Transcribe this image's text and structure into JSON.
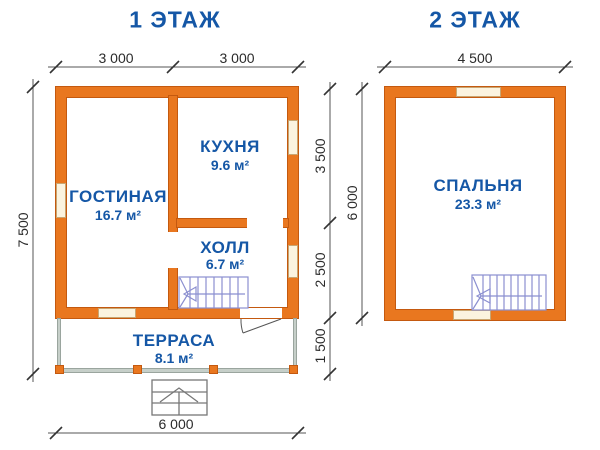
{
  "colors": {
    "wall_orange": "#E9771F",
    "wall_outline": "#C4590F",
    "window_fill": "#FBF3DF",
    "window_outline": "#C9A671",
    "label_blue": "#1557A6",
    "terrace_wall": "#C6CFC9",
    "stair_line": "#8B8FD0",
    "dimension_line": "#555555",
    "background": "#FFFFFF"
  },
  "floor1": {
    "title": "1 ЭТАЖ",
    "rooms": [
      {
        "name": "ГОСТИНАЯ",
        "area": "16.7 м²"
      },
      {
        "name": "КУХНЯ",
        "area": "9.6 м²"
      },
      {
        "name": "ХОЛЛ",
        "area": "6.7 м²"
      },
      {
        "name": "ТЕРРАСА",
        "area": "8.1 м²"
      }
    ],
    "dimensions": {
      "top_left": "3 000",
      "top_right": "3 000",
      "left_total": "7 500",
      "mid_upper": "3 500",
      "mid_lower": "2 500",
      "mid_terrace": "1 500",
      "bottom_total": "6 000"
    }
  },
  "floor2": {
    "title": "2 ЭТАЖ",
    "rooms": [
      {
        "name": "СПАЛЬНЯ",
        "area": "23.3 м²"
      }
    ],
    "dimensions": {
      "top_total": "4 500",
      "left_total": "6 000"
    }
  }
}
